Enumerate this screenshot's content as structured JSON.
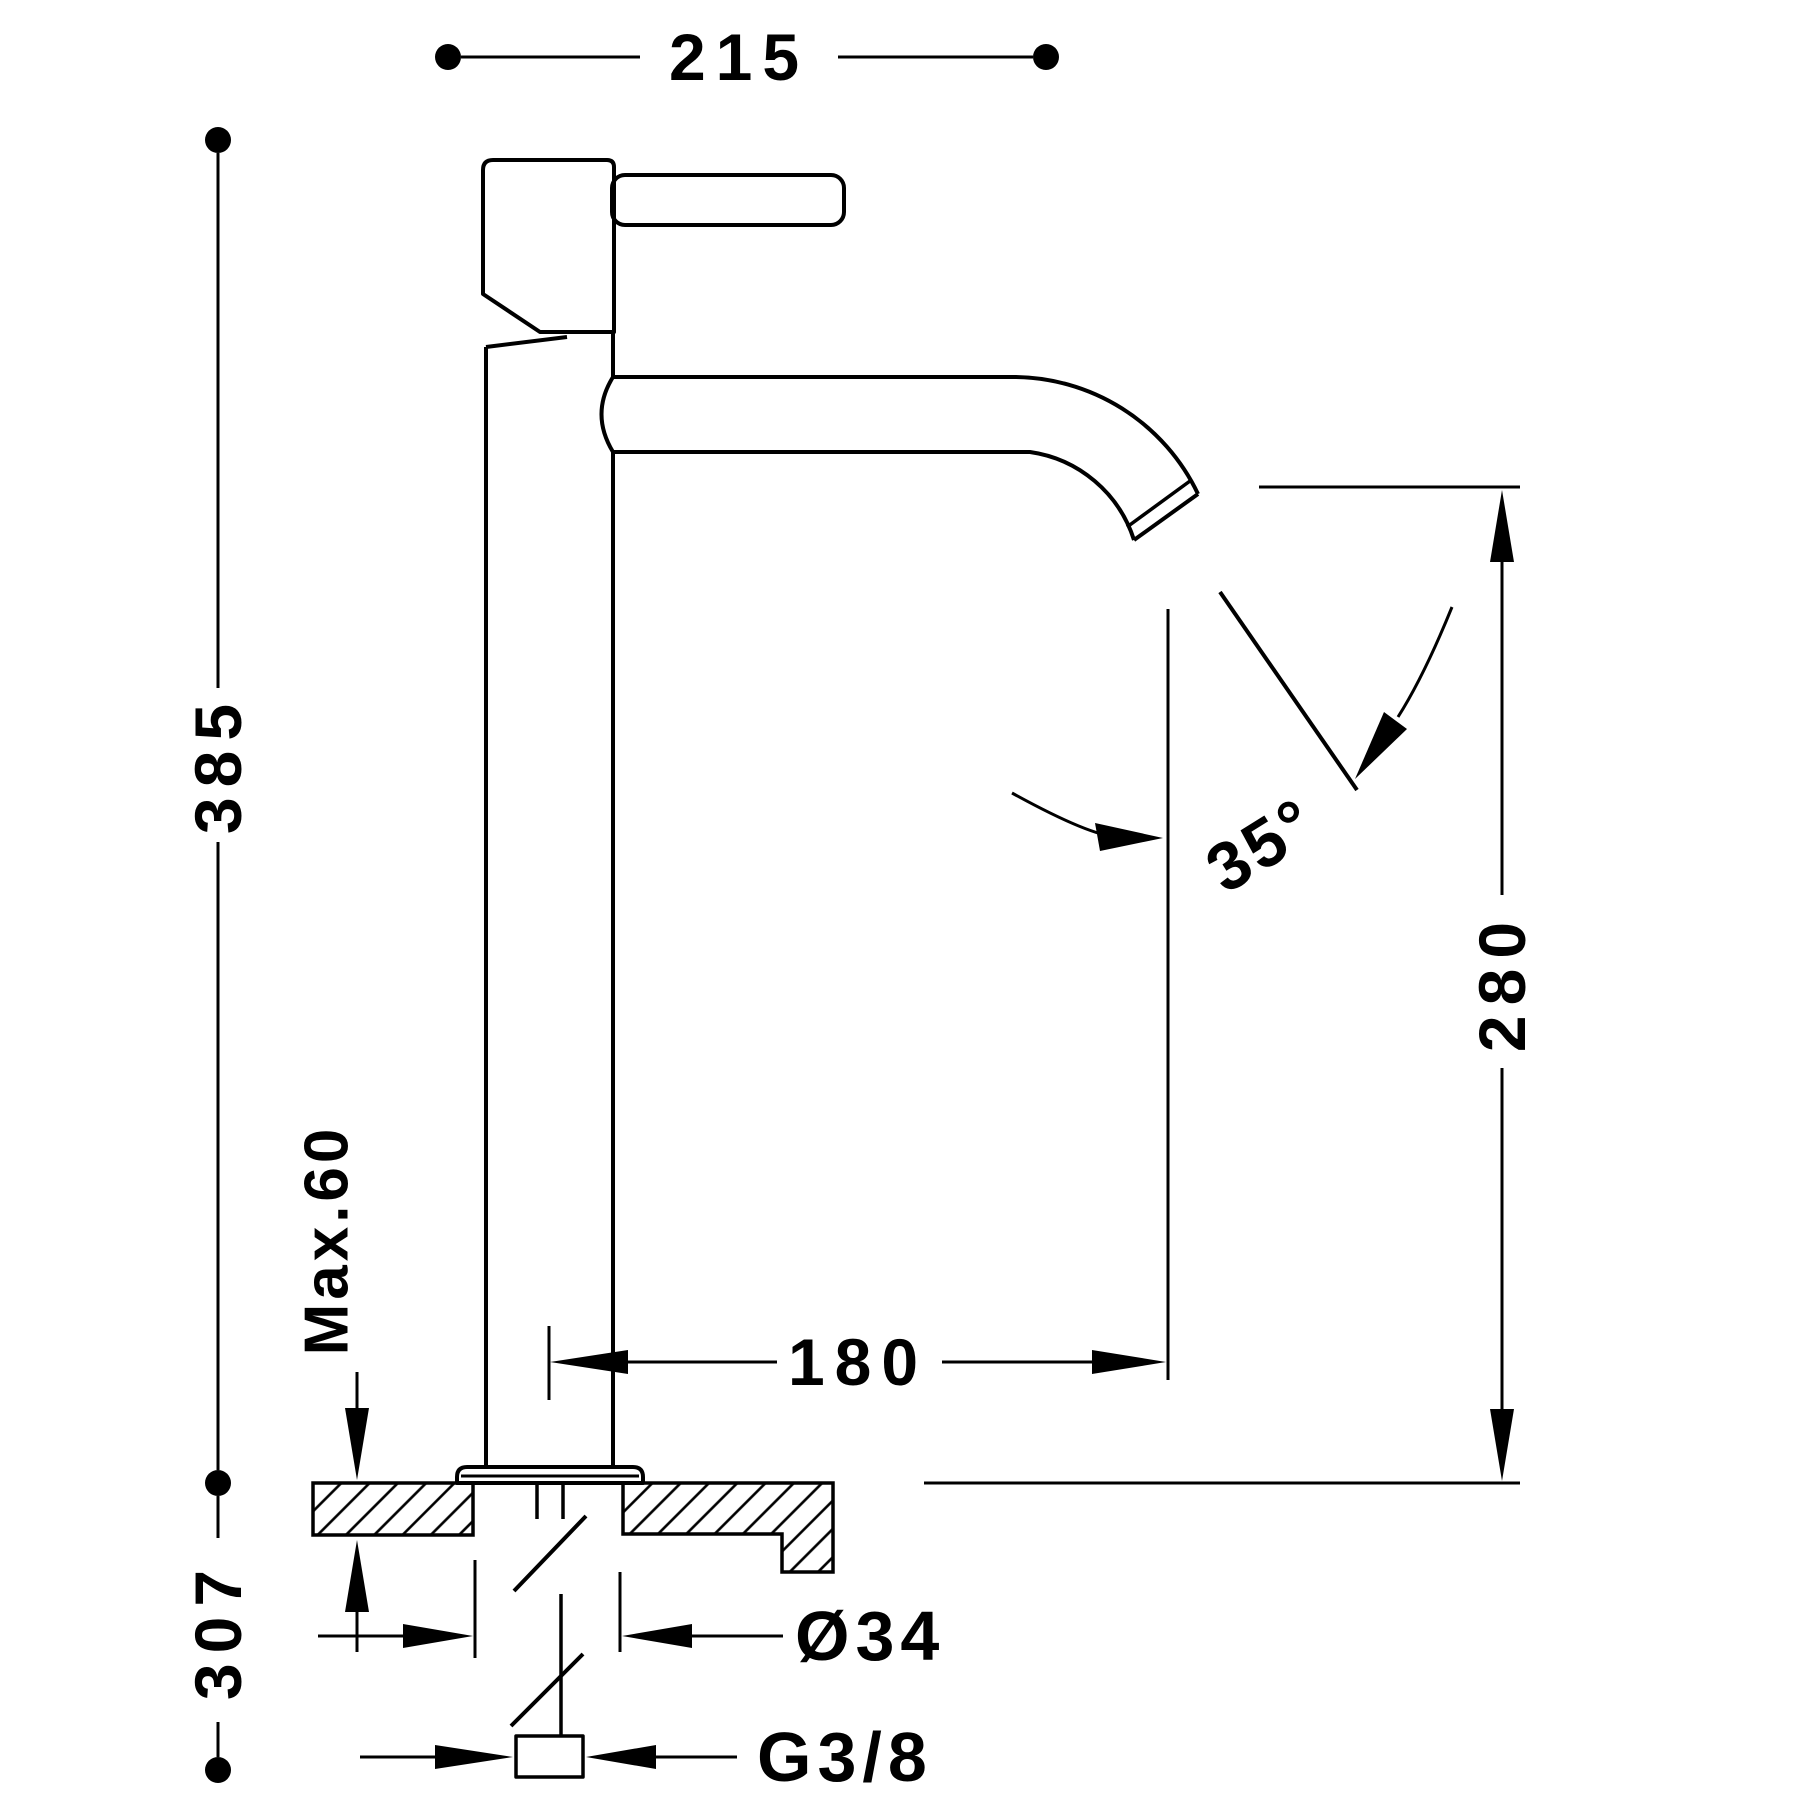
{
  "meta": {
    "background_color": "#ffffff",
    "line_color": "#000000",
    "drawing_type": "technical dimension drawing",
    "subject": "single-lever tall basin mixer tap, side elevation with deck cross-section"
  },
  "labels": {
    "total_width": "215",
    "total_height": "385",
    "height_below": "307",
    "max_deck_thickness": "Max.60",
    "outlet_height": "280",
    "spout_reach": "180",
    "outlet_angle": "35°",
    "hole_diameter": "Ø34",
    "inlet_thread": "G3/8"
  }
}
